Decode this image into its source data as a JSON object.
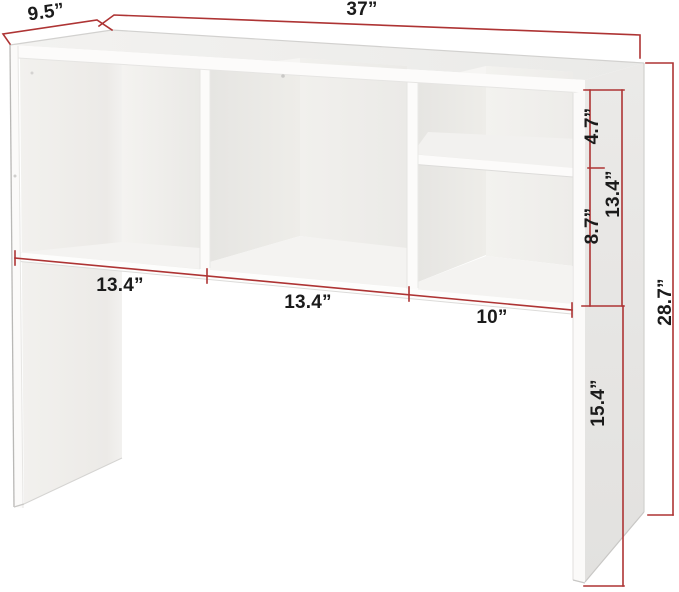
{
  "figure_type": "furniture-dimension-diagram",
  "product": {
    "name": "desk hutch bookshelf with cubbies"
  },
  "dimensions": {
    "overall_width": "37”",
    "overall_depth": "9.5”",
    "overall_height": "28.7”",
    "left_cubby_width": "13.4”",
    "middle_cubby_width": "13.4”",
    "right_section_width": "10”",
    "right_section_height": "13.4”",
    "upper_right_cubby_height": "4.7”",
    "lower_right_cubby_height": "8.7”",
    "leg_height": "15.4”"
  },
  "colors": {
    "dimension_lines": "#ae3434",
    "dimension_text": "#1b1b1b",
    "furniture_white": "#fbfbfa",
    "panel_gray": "#e8e7e5",
    "background": "#ffffff"
  }
}
